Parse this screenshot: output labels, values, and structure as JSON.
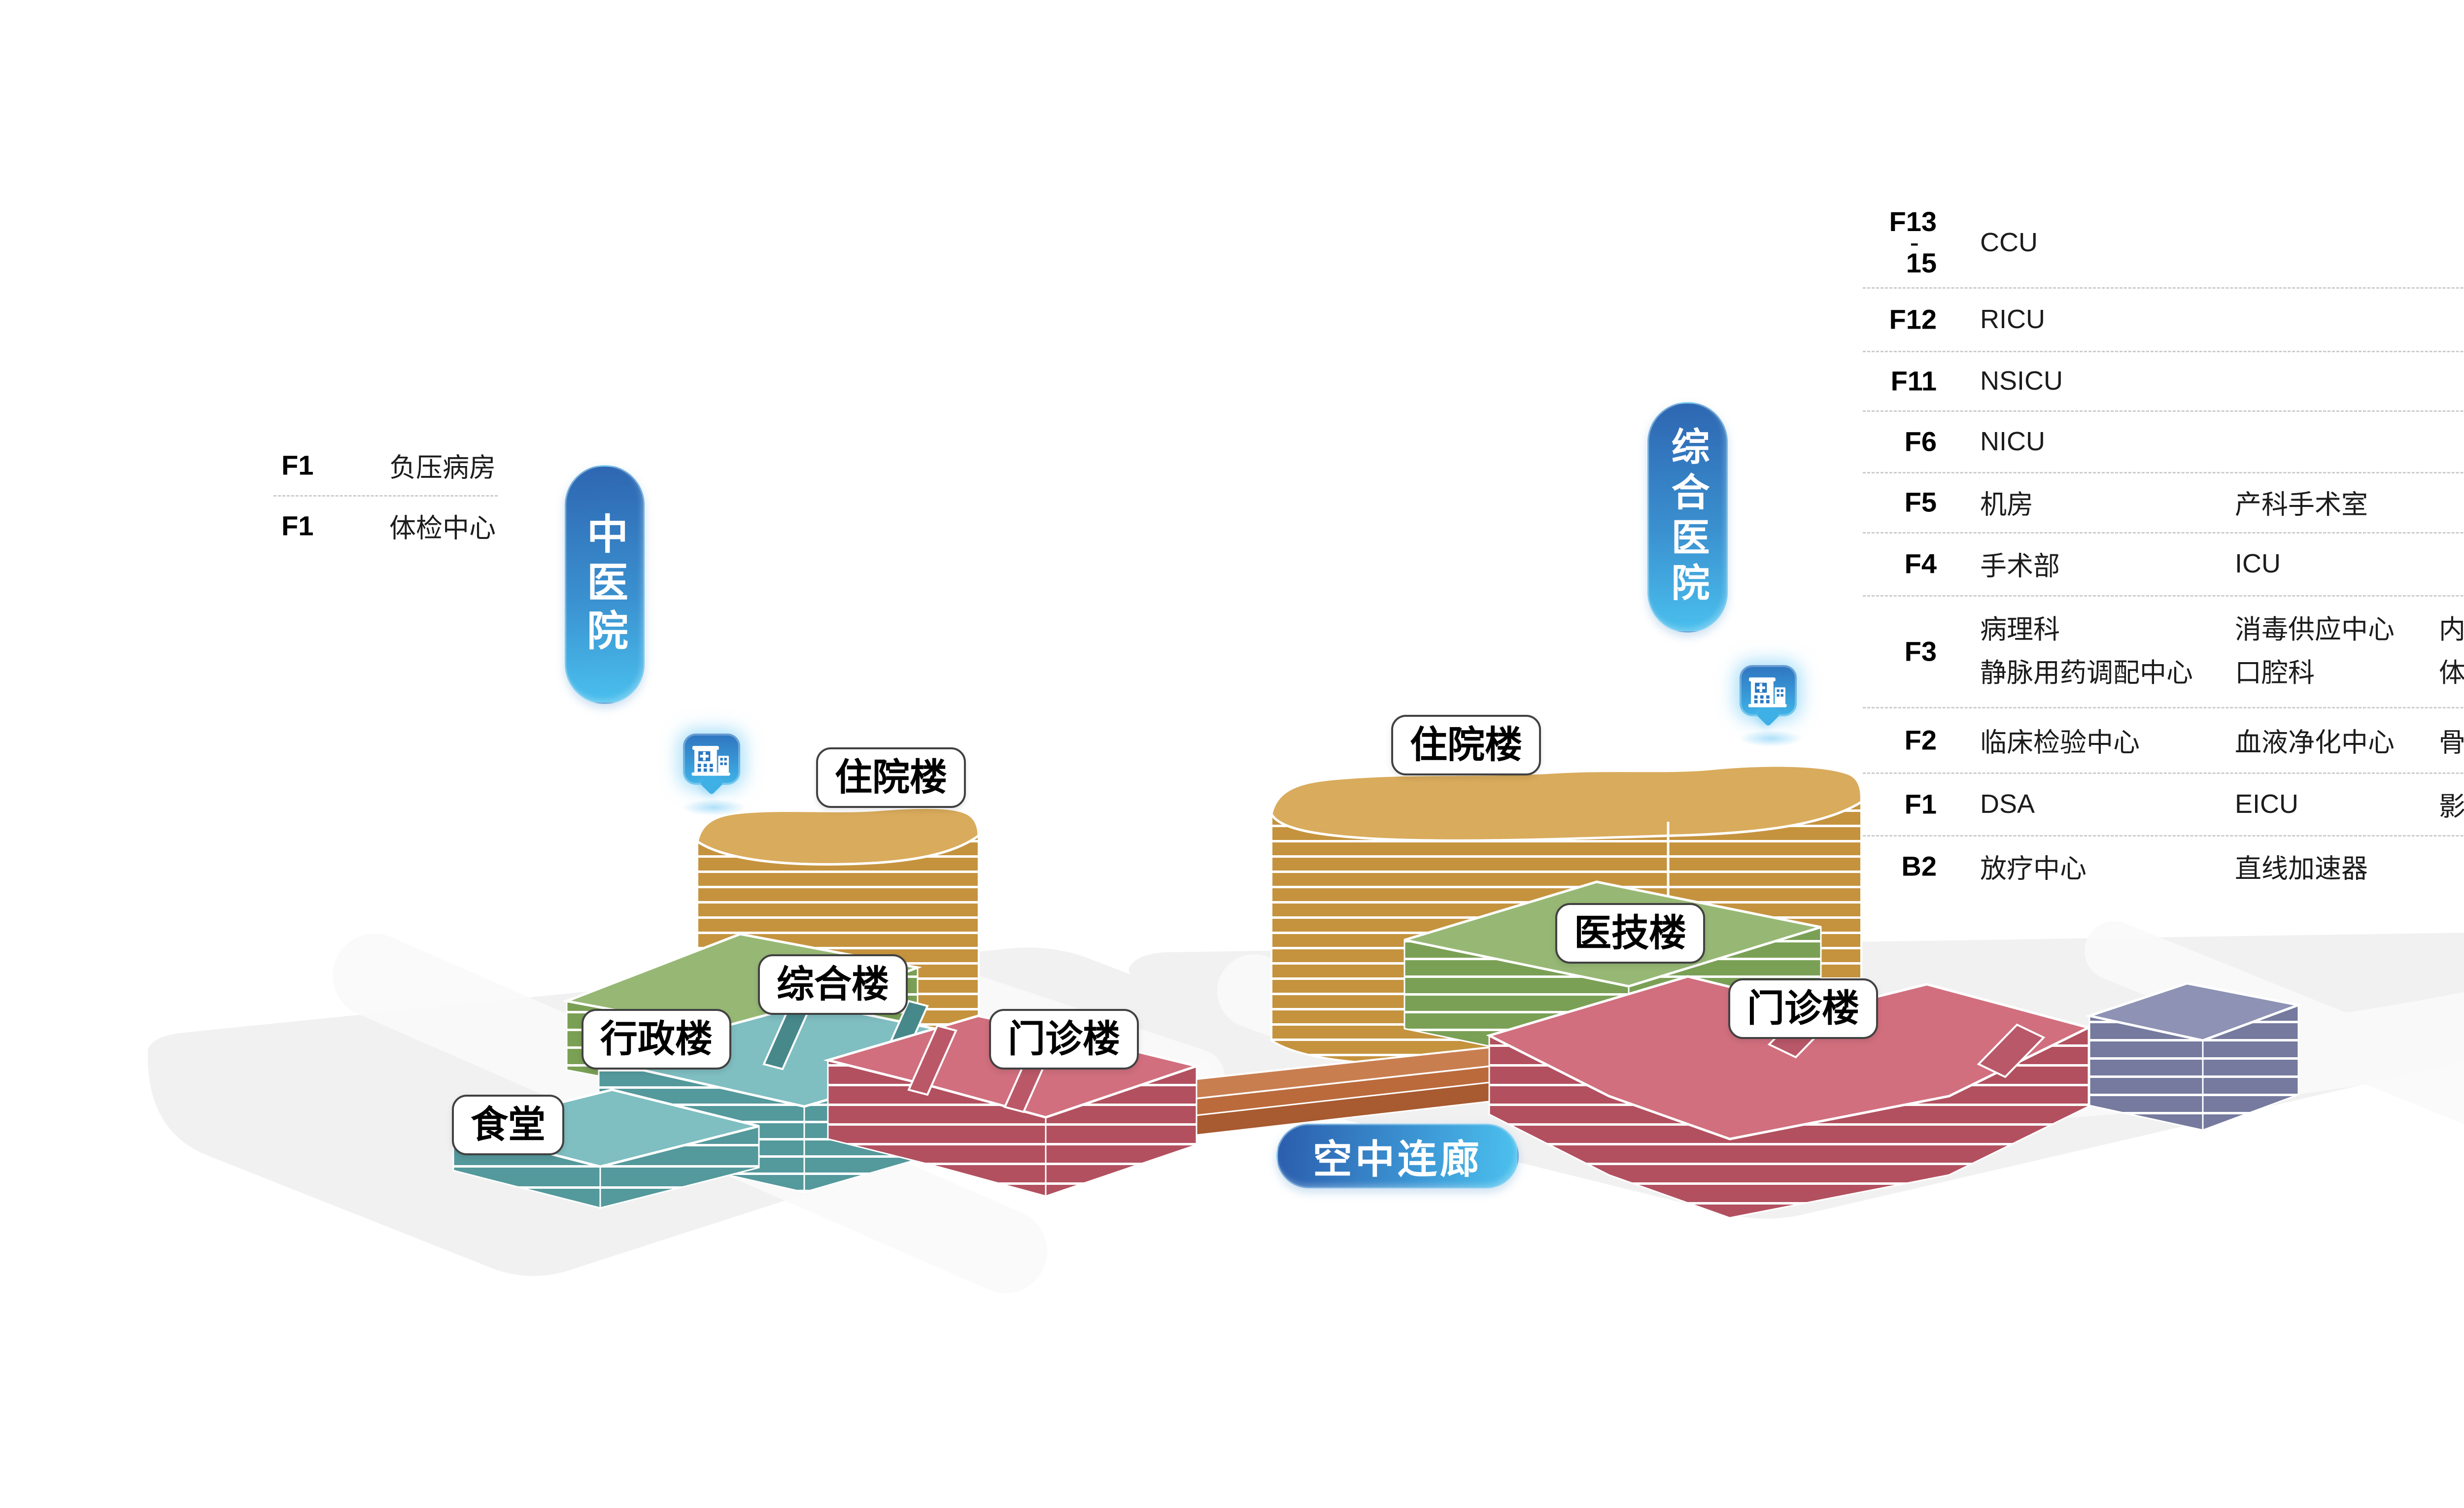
{
  "scene": {
    "campus_left": "中医院",
    "campus_right": "综合医院",
    "bridge": "空中连廊",
    "buildings": {
      "left_inpatient": "住院楼",
      "left_complex": "综合楼",
      "left_admin": "行政楼",
      "canteen": "食堂",
      "left_outpatient": "门诊楼",
      "right_inpatient": "住院楼",
      "right_medtech": "医技楼",
      "right_outpatient": "门诊楼"
    }
  },
  "left_list": {
    "rows": [
      {
        "floor": "F1",
        "name": "负压病房"
      },
      {
        "floor": "F1",
        "name": "体检中心"
      }
    ]
  },
  "right_list": {
    "rows": [
      {
        "floor_lines": [
          "F13",
          "-",
          "15"
        ],
        "cols": [
          "CCU"
        ]
      },
      {
        "floor": "F12",
        "cols": [
          "RICU"
        ]
      },
      {
        "floor": "F11",
        "cols": [
          "NSICU"
        ]
      },
      {
        "floor": "F6",
        "cols": [
          "NICU"
        ]
      },
      {
        "floor": "F5",
        "cols": [
          "机房",
          "产科手术室"
        ]
      },
      {
        "floor": "F4",
        "cols": [
          "手术部",
          "ICU"
        ]
      },
      {
        "floor": "F3",
        "cols_top": [
          "病理科",
          "消毒供应中心",
          "内镜中心"
        ],
        "cols_bottom": [
          "静脉用药调配中心",
          "口腔科",
          "体外碎石中心"
        ]
      },
      {
        "floor": "F2",
        "cols": [
          "临床检验中心",
          "血液净化中心",
          "骨密度"
        ]
      },
      {
        "floor": "F1",
        "cols": [
          "DSA",
          "EICU",
          "影像中心"
        ]
      },
      {
        "floor": "B2",
        "cols": [
          "放疗中心",
          "直线加速器"
        ]
      }
    ]
  },
  "colors": {
    "accent_blue_dark": "#2e66b2",
    "accent_blue_light": "#4ac0ee",
    "gold_top": "#d9ab5c",
    "gold_side": "#c5933e",
    "green_top": "#97b875",
    "green_side": "#7aa055",
    "teal_top": "#7fbec1",
    "teal_side": "#54999c",
    "red_top": "#d16f7e",
    "red_side": "#b2505f",
    "purple_top": "#8e92b4",
    "purple_side": "#757a9e",
    "bridge_top": "#c97e50",
    "bridge_side": "#a85a30",
    "ground": "#f1f1f2",
    "divider": "#cccccc",
    "label_border": "#414141"
  }
}
